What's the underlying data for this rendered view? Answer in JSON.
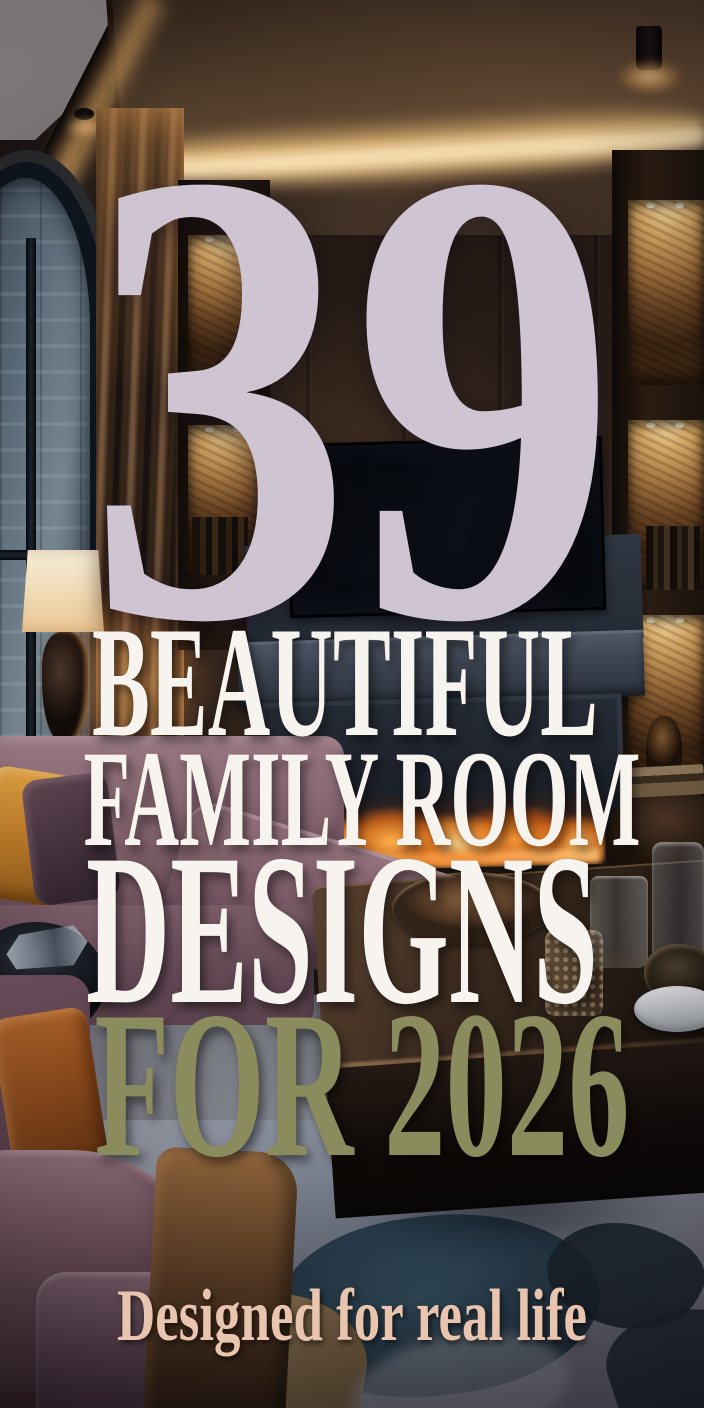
{
  "poster": {
    "count": "39",
    "headline": [
      "BEAUTIFUL",
      "FAMILY ROOM",
      "DESIGNS"
    ],
    "accent_line": "FOR 2026",
    "tagline": "Designed for real life",
    "colors": {
      "count": "#cec4d2",
      "headline": "#f7f4ef",
      "accent": "#8b8c5e",
      "tagline": "#e9c4ae"
    }
  },
  "scene": {
    "colors": {
      "cove_light": "#f2b96a",
      "sofa_velvet": "#8a6a76",
      "pillow_amber": "#c98a33",
      "pillow_rust": "#a85c28",
      "flame": "#ff9e3b",
      "shelf_stone": "#c99a5c",
      "rug_teal": "#2c4a5c",
      "rug_base": "#8c92a0",
      "lamp_shade": "#f0dab4"
    }
  }
}
